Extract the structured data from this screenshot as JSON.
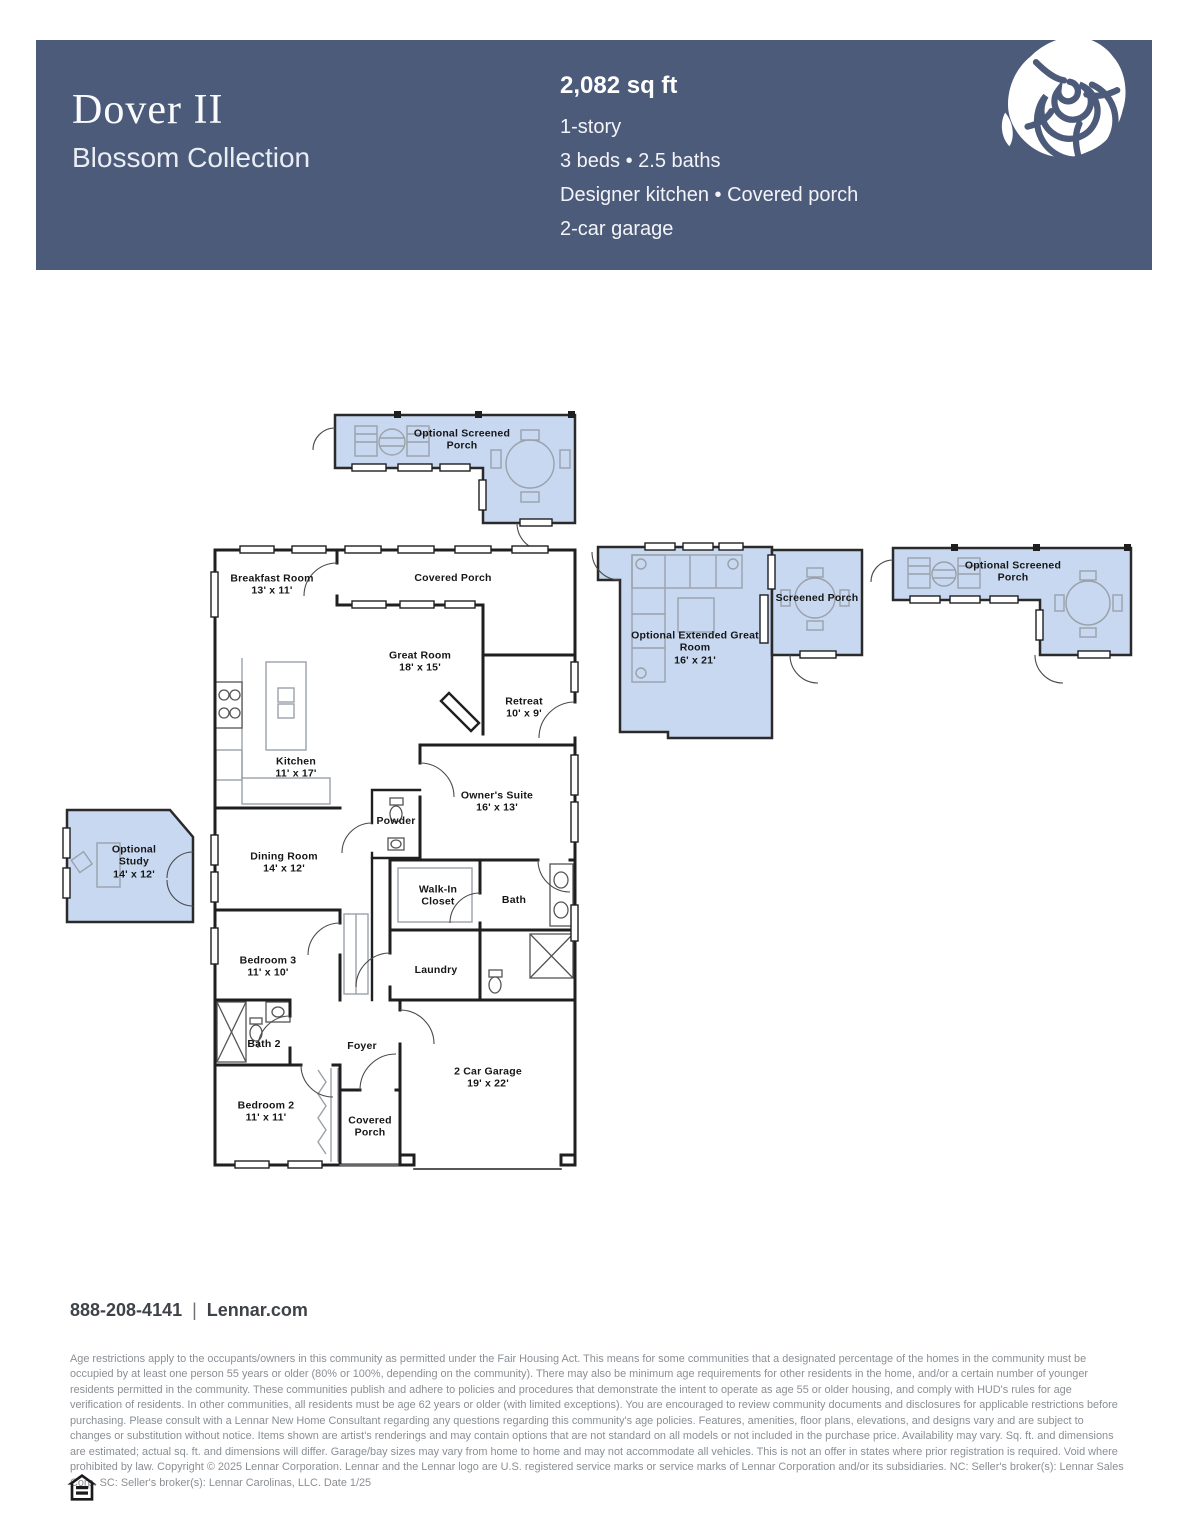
{
  "header": {
    "plan_name": "Dover II",
    "collection": "Blossom Collection",
    "sqft": "2,082 sq ft",
    "specs": [
      "1-story",
      "3 beds • 2.5 baths",
      "Designer kitchen • Covered porch",
      "2-car garage"
    ],
    "colors": {
      "background": "#4d5b7a",
      "text": "#ffffff"
    },
    "logo": "lennar-rose-icon"
  },
  "floorplan": {
    "colors": {
      "optional_area_fill": "#c7d8f0",
      "walls": "#1f1f1f",
      "furniture": "#9aa1aa"
    },
    "rooms": [
      {
        "name": "Optional Screened Porch",
        "dims": ""
      },
      {
        "name": "Breakfast Room",
        "dims": "13' x 11'"
      },
      {
        "name": "Covered Porch",
        "dims": ""
      },
      {
        "name": "Great Room",
        "dims": "18' x 15'"
      },
      {
        "name": "Retreat",
        "dims": "10' x 9'"
      },
      {
        "name": "Optional Extended Great Room",
        "dims": "16' x 21'"
      },
      {
        "name": "Screened Porch",
        "dims": ""
      },
      {
        "name": "Optional Screened Porch",
        "dims": ""
      },
      {
        "name": "Kitchen",
        "dims": "11' x 17'"
      },
      {
        "name": "Powder",
        "dims": ""
      },
      {
        "name": "Owner's Suite",
        "dims": "16' x 13'"
      },
      {
        "name": "Optional Study",
        "dims": "14' x 12'"
      },
      {
        "name": "Dining Room",
        "dims": "14' x 12'"
      },
      {
        "name": "Walk-In Closet",
        "dims": ""
      },
      {
        "name": "Bath",
        "dims": ""
      },
      {
        "name": "Bedroom 3",
        "dims": "11' x 10'"
      },
      {
        "name": "Laundry",
        "dims": ""
      },
      {
        "name": "Bath 2",
        "dims": ""
      },
      {
        "name": "Foyer",
        "dims": ""
      },
      {
        "name": "Bedroom 2",
        "dims": "11' x 11'"
      },
      {
        "name": "Covered Porch",
        "dims": ""
      },
      {
        "name": "2 Car Garage",
        "dims": "19' x 22'"
      }
    ]
  },
  "footer": {
    "phone": "888-208-4141",
    "separator": "|",
    "website": "Lennar.com",
    "legal": "Age restrictions apply to the occupants/owners in this community as permitted under the Fair Housing Act. This means for some communities that a designated percentage of the homes in the community must be occupied by at least one person 55 years or older (80% or 100%, depending on the community). There may also be minimum age requirements for other residents in the home, and/or a certain number of younger residents permitted in the community. These communities publish and adhere to policies and procedures that demonstrate the intent to operate as age 55 or older housing, and comply with HUD's rules for age verification of residents. In other communities, all residents must be age 62 years or older (with limited exceptions). You are encouraged to review community documents and disclosures for applicable restrictions before purchasing. Please consult with a Lennar New Home Consultant regarding any questions regarding this community's age policies. Features, amenities, floor plans, elevations, and designs vary and are subject to changes or substitution without notice. Items shown are artist's renderings and may contain options that are not standard on all models or not included in the purchase price. Availability may vary. Sq. ft. and dimensions are estimated; actual sq. ft. and dimensions will differ. Garage/bay sizes may vary from home to home and may not accommodate all vehicles. This is not an offer in states where prior registration is required. Void where prohibited by law. Copyright © 2025 Lennar Corporation. Lennar and the Lennar logo are U.S. registered service marks or service marks of Lennar Corporation and/or its subsidiaries. NC: Seller's broker(s): Lennar Sales Corp. SC: Seller's broker(s): Lennar Carolinas, LLC. Date 1/25",
    "eho_icon": "equal-housing-icon"
  }
}
